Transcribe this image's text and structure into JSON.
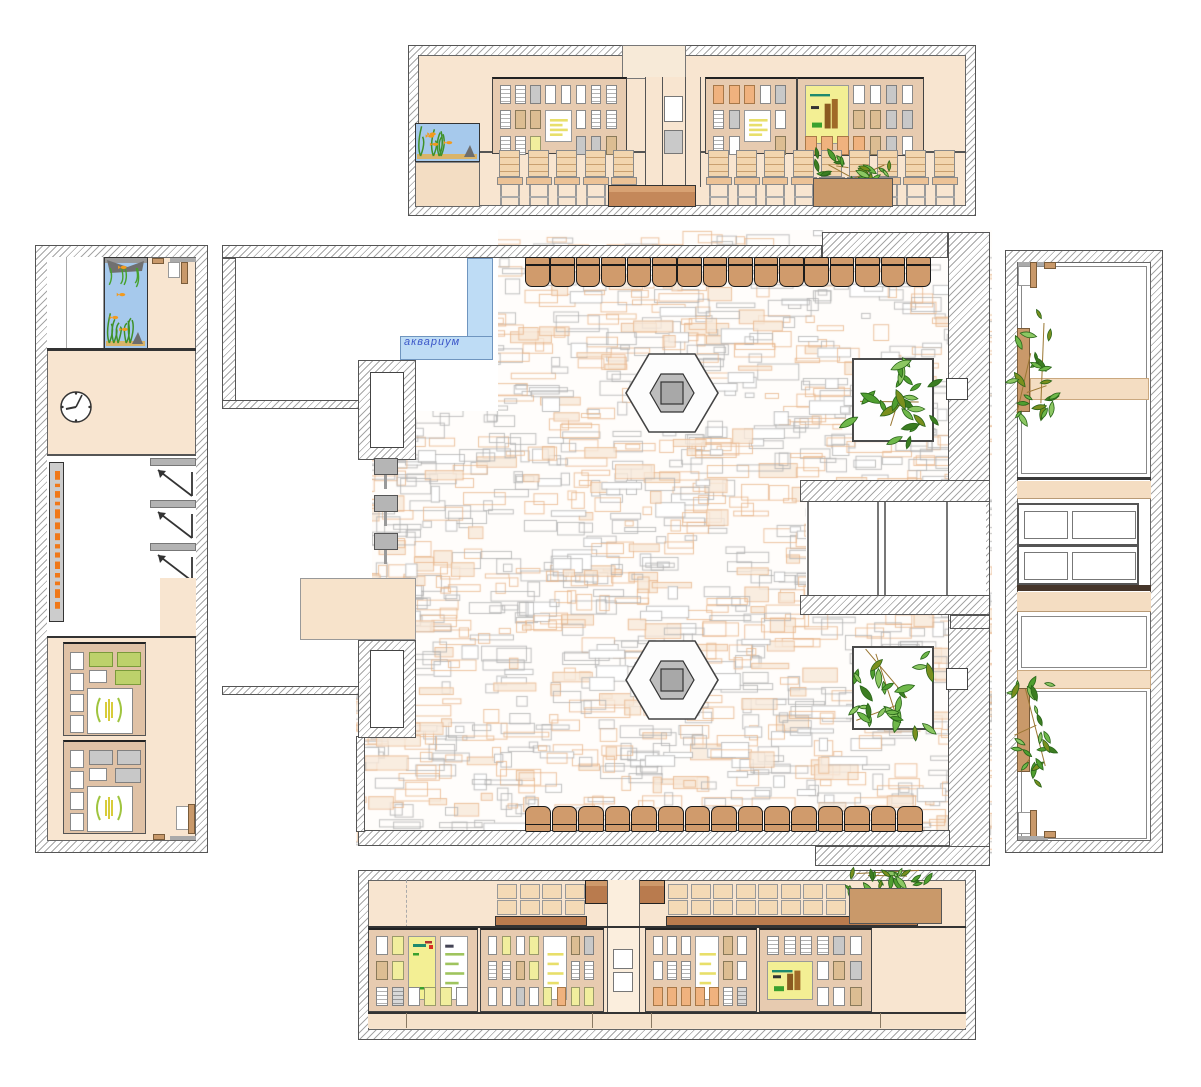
{
  "title": "Interior floor plan with four wall elevations",
  "plan": {
    "aquarium_label": "аквариум",
    "label_color": "#3a55c8",
    "chairs_top": 16,
    "chairs_bottom": 15,
    "hex_columns": 2,
    "plant_beds": 2,
    "wall_niches": 2,
    "coat_hooks": 3
  },
  "elevations": {
    "top": {
      "boards": 3,
      "chairs_left": 5,
      "chairs_right": 9,
      "aquarium": true,
      "planter": true
    },
    "bottom": {
      "boards": 4,
      "chair_backs_left": 4,
      "chair_backs_right": 8,
      "planter": true
    },
    "left": {
      "boards": 2,
      "coat_hooks": 3,
      "clock": true,
      "aquarium": true,
      "sign": true
    },
    "right": {
      "windows": 2,
      "planters": 2,
      "panel_rows": 2
    }
  },
  "colors": {
    "peach": "#f8e5d0",
    "peach_band": "#f4ddc2",
    "board_tan": "#e7cbb0",
    "board_tan2": "#e0c2a6",
    "console_brown": "#c4885a",
    "console_dark": "#b97b4e",
    "chair_brown": "#d09b6c",
    "chair_peach": "#f2d5ae",
    "seat_peach": "#ecc296",
    "aquarium_blue": "#a6c9ec",
    "plan_aquarium_blue": "#bedcf5",
    "planter_tan": "#c9996a",
    "leaf_green": "#4f9e30",
    "poster_yellow": "#f3ef94",
    "card_white": "#ffffff",
    "card_gray": "#c8c8c8",
    "card_tan": "#dcbd92",
    "card_yellow": "#f1ee9d",
    "card_orange": "#f0b27e",
    "card_green": "#bdd16b",
    "stone_gray": "#b6b6b6",
    "stone_orange": "#e8b68c",
    "sign_orange": "#f07818",
    "wall_line": "#555555"
  },
  "boards": {
    "top_left": {
      "cols": 8,
      "rows": [
        "eegwwwee",
        "ett..wee",
        "eey..ggt"
      ],
      "posters": [
        {
          "col": 3,
          "row": 1,
          "colspan": 2,
          "rowspan": 2,
          "style": "doc-yellow"
        }
      ]
    },
    "top_right": {
      "cols": 5,
      "rows": [
        "ooowg",
        "eg..w",
        "ew..t"
      ],
      "posters": [
        {
          "col": 2,
          "row": 1,
          "colspan": 2,
          "rowspan": 2,
          "style": "doc-yellow"
        }
      ]
    },
    "top_far": {
      "cols": 7,
      "rows": [
        "...wwgw",
        "...ttgg",
        "ooootgw"
      ],
      "posters": [
        {
          "col": 0,
          "row": 0,
          "colspan": 3,
          "rowspan": 2,
          "style": "chart-yellow"
        }
      ]
    },
    "bottom_a": {
      "cols": 6,
      "rows": [
        "wy....",
        "ty....",
        "enwyyw"
      ],
      "posters": [
        {
          "col": 2,
          "row": 0,
          "colspan": 2,
          "rowspan": 2,
          "style": "note-yellow"
        },
        {
          "col": 4,
          "row": 0,
          "colspan": 2,
          "rowspan": 2,
          "style": "doc-green"
        }
      ]
    },
    "bottom_b": {
      "cols": 8,
      "rows": [
        "wywy..tg",
        "eety..ee",
        "wwgwyoyy"
      ],
      "posters": [
        {
          "col": 4,
          "row": 0,
          "colspan": 2,
          "rowspan": 2,
          "style": "doc-yellow"
        }
      ]
    },
    "bottom_c": {
      "cols": 7,
      "rows": [
        "www..tw",
        "wee..tw",
        "oooooen"
      ],
      "posters": [
        {
          "col": 3,
          "row": 0,
          "colspan": 2,
          "rowspan": 2,
          "style": "doc-yellow"
        }
      ]
    },
    "bottom_d": {
      "cols": 6,
      "rows": [
        "eeeegw",
        "...wtg",
        "...wwt"
      ],
      "posters": [
        {
          "col": 0,
          "row": 1,
          "colspan": 3,
          "rowspan": 2,
          "style": "chart-yellow"
        }
      ]
    },
    "left_1": {
      "accent": "G"
    },
    "left_2": {
      "accent": "g"
    }
  }
}
